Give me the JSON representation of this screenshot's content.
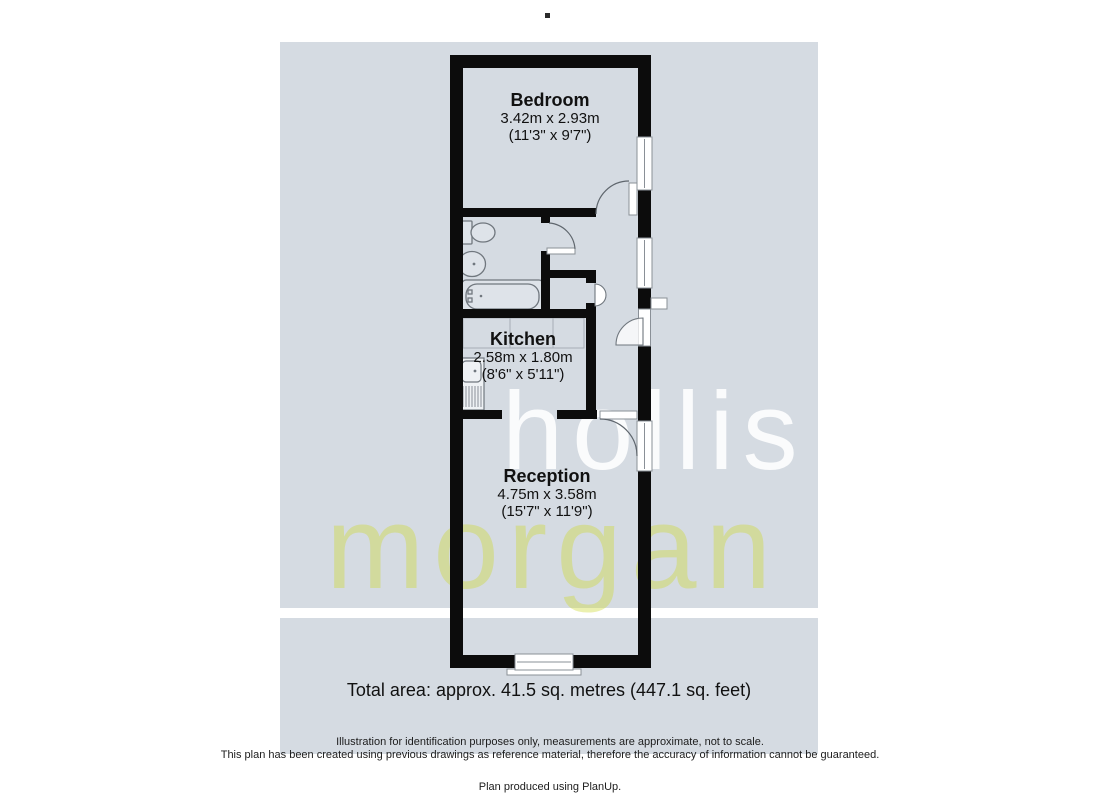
{
  "canvas": {
    "background_color": "#ffffff",
    "plan_background_color": "#d5dbe2",
    "wall_color": "#0c0c0c"
  },
  "watermark": {
    "word1": "hollis",
    "word2": "morgan",
    "word1_color": "#ffffff",
    "word2_color": "#cdd937"
  },
  "rooms": {
    "bedroom": {
      "name": "Bedroom",
      "metric": "3.42m x 2.93m",
      "imperial": "(11'3\" x 9'7\")"
    },
    "kitchen": {
      "name": "Kitchen",
      "metric": "2.58m x 1.80m",
      "imperial": "(8'6\" x 5'11\")"
    },
    "reception": {
      "name": "Reception",
      "metric": "4.75m x 3.58m",
      "imperial": "(15'7\" x 11'9\")"
    }
  },
  "summary": {
    "total_area": "Total area: approx. 41.5 sq. metres (447.1 sq. feet)"
  },
  "disclaimer": {
    "line1": "Illustration for identification purposes only, measurements are approximate, not to scale.",
    "line2": "This plan has been created using previous drawings as reference material, therefore the accuracy of information cannot be guaranteed."
  },
  "footer": {
    "credit": "Plan produced using PlanUp."
  }
}
